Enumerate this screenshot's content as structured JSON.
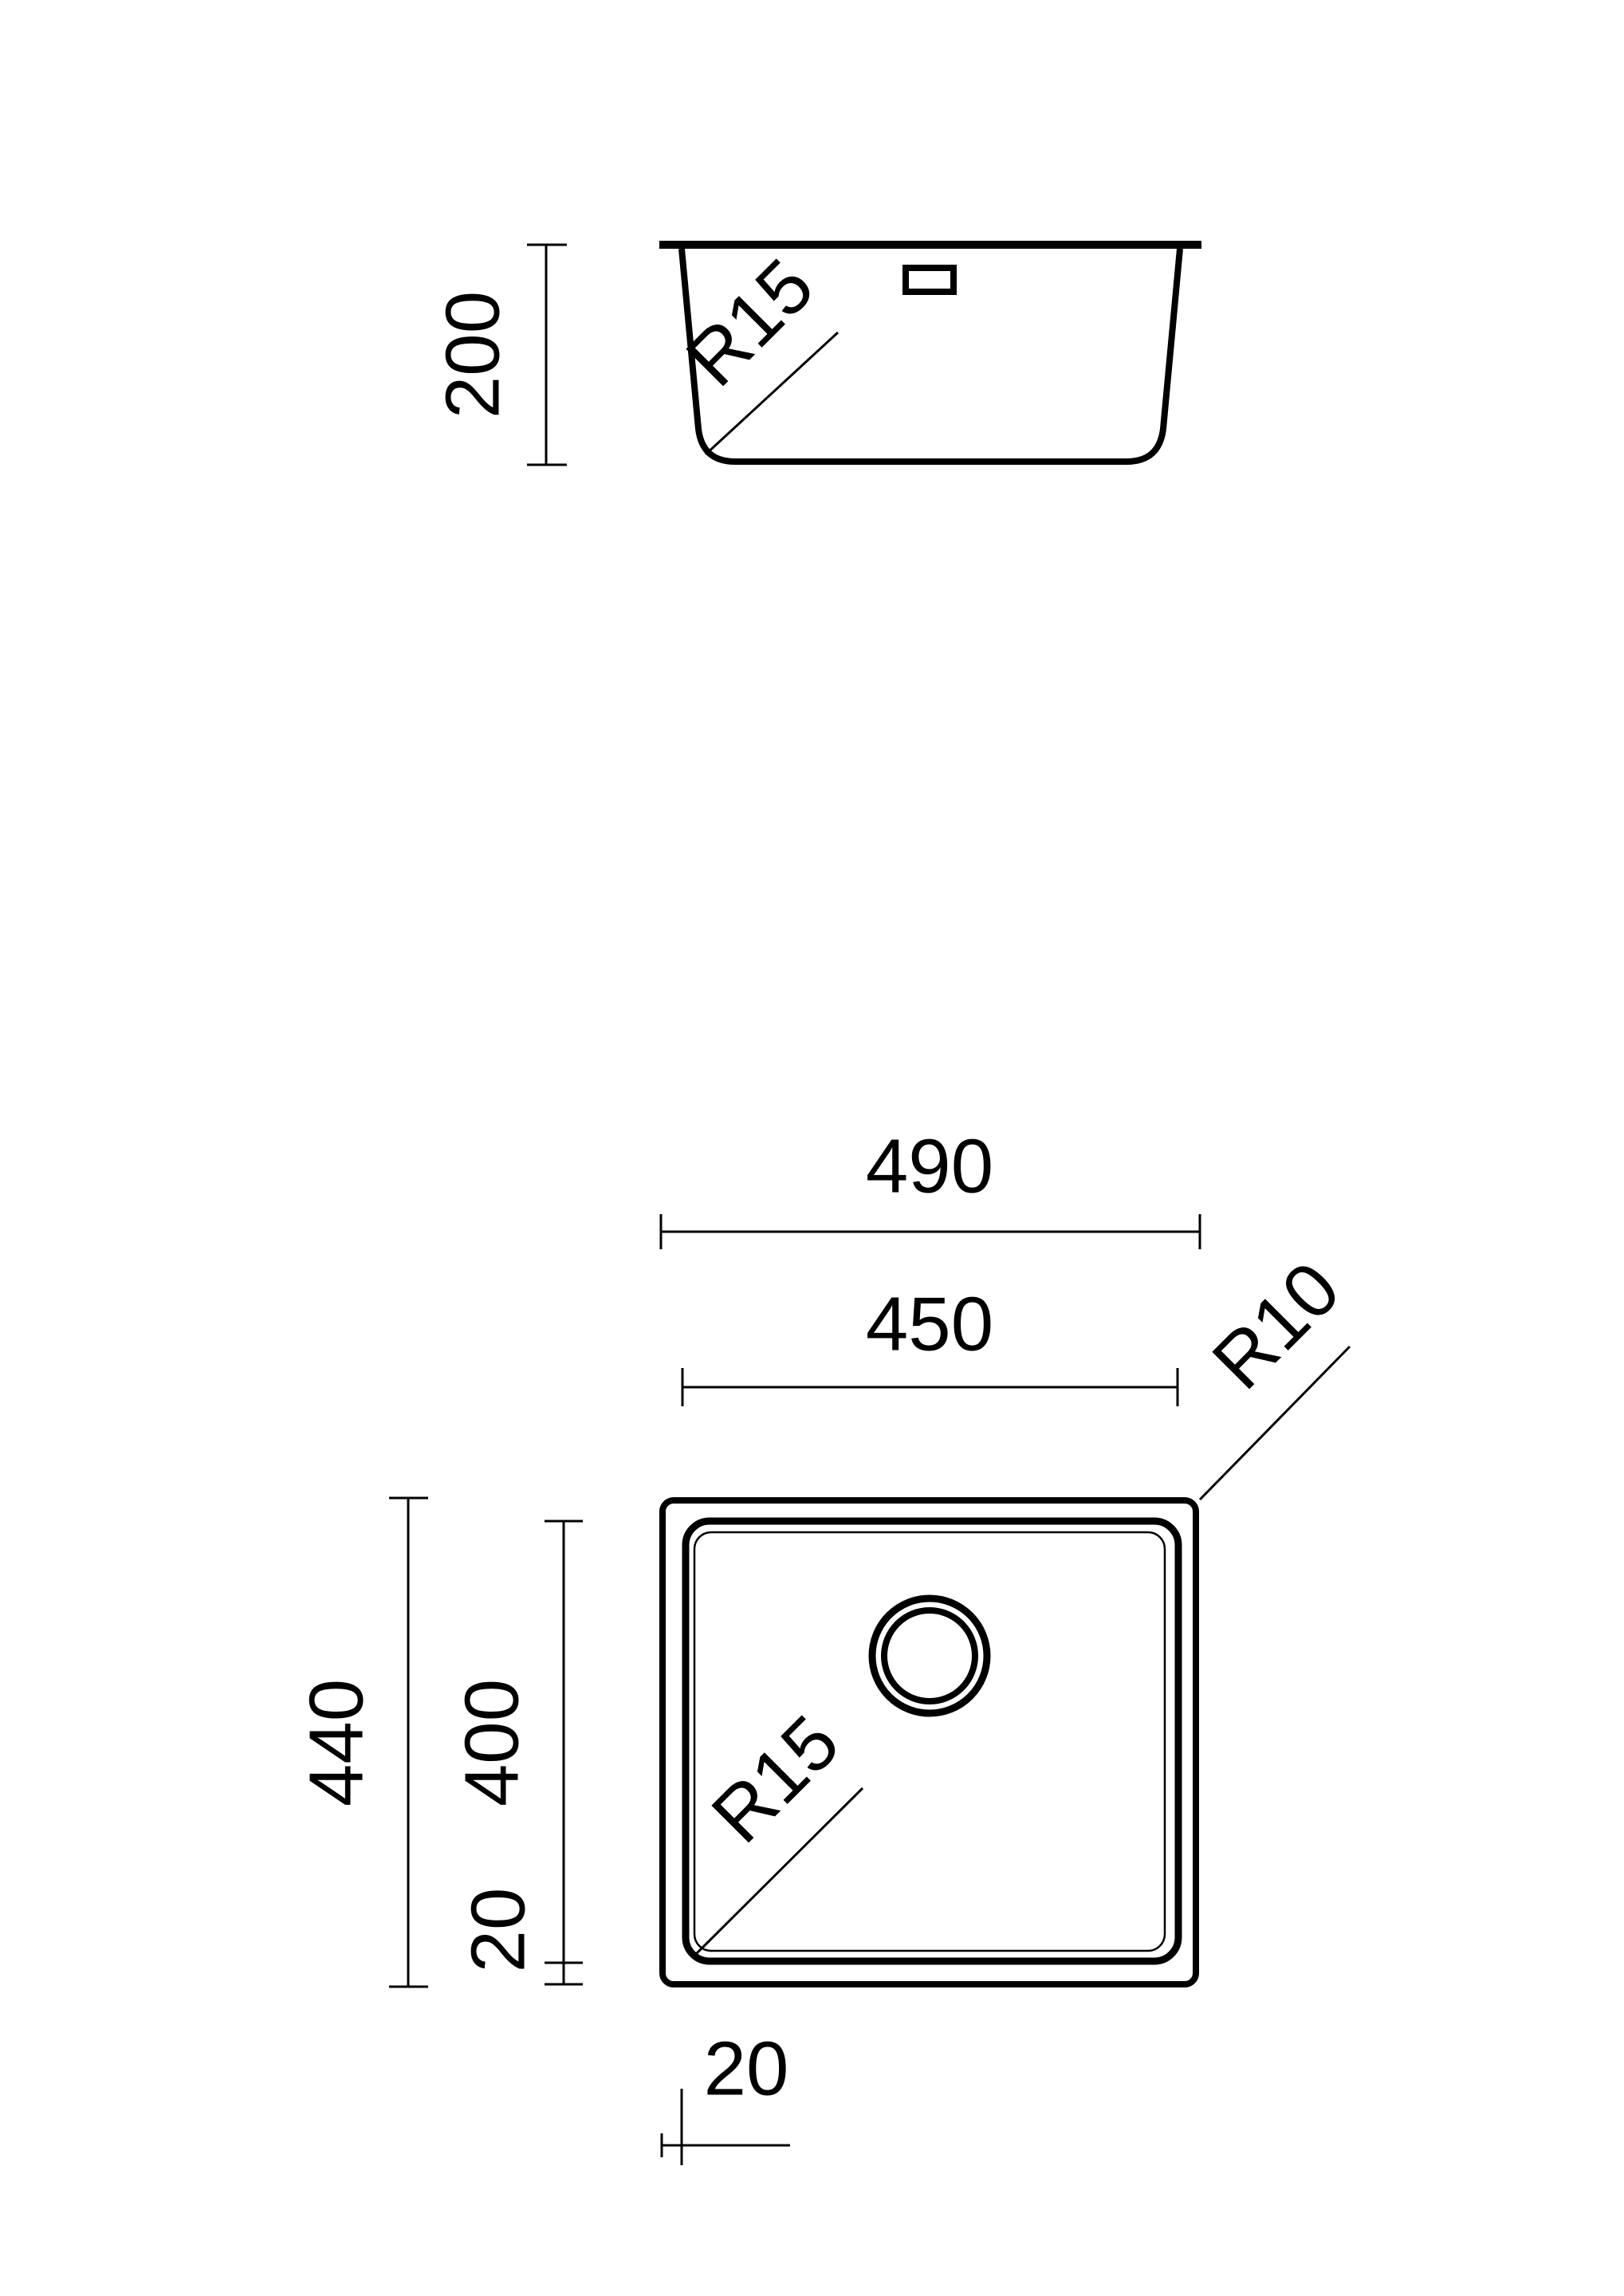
{
  "canvas": {
    "background": "#ffffff",
    "line_color": "#000000"
  },
  "side_view": {
    "height_dim": "200",
    "corner_radius_label": "R15"
  },
  "plan_view": {
    "overall_width_dim": "490",
    "bowl_width_dim": "450",
    "outer_corner_radius_label": "R10",
    "overall_depth_dim": "440",
    "bowl_depth_dim": "400",
    "bowl_offset_vertical_dim": "20",
    "bowl_offset_horizontal_dim": "20",
    "bowl_corner_radius_label": "R15"
  }
}
